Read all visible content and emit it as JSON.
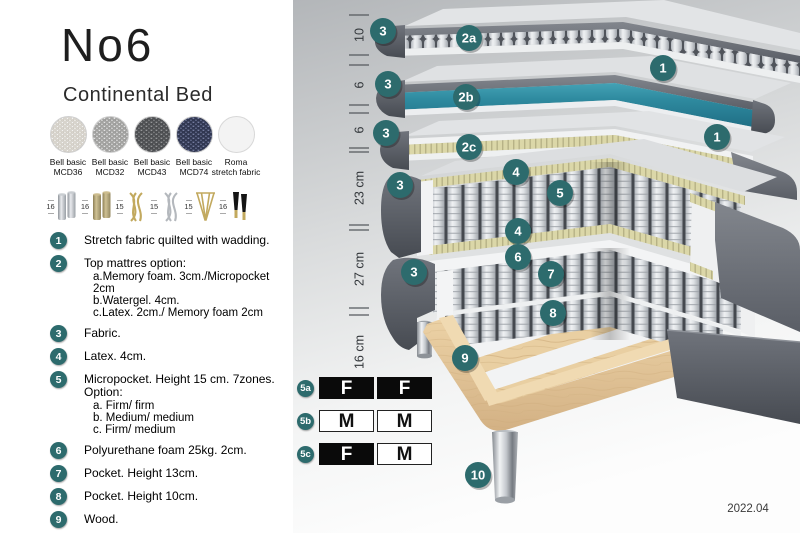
{
  "header": {
    "title": "No6",
    "subtitle": "Continental Bed"
  },
  "swatches": [
    {
      "name": "Bell basic",
      "code": "MCD36"
    },
    {
      "name": "Bell basic",
      "code": "MCD32"
    },
    {
      "name": "Bell basic",
      "code": "MCD43"
    },
    {
      "name": "Bell basic",
      "code": "MCD74"
    },
    {
      "name": "Roma",
      "code": "stretch fabric"
    }
  ],
  "legs": [
    {
      "height": "16",
      "type": "cylinder-silver"
    },
    {
      "height": "16",
      "type": "cylinder-brass"
    },
    {
      "height": "15",
      "type": "twisted-gold"
    },
    {
      "height": "15",
      "type": "twisted-silver"
    },
    {
      "height": "15",
      "type": "hairpin-gold"
    },
    {
      "height": "16",
      "type": "tapered-black-brass"
    }
  ],
  "legend": [
    {
      "num": "1",
      "text": "Stretch fabric quilted with wadding.",
      "sub": []
    },
    {
      "num": "2",
      "text": "Top mattres option:",
      "sub": [
        "a.Memory foam. 3cm./Micropocket 2cm",
        "b.Watergel. 4cm.",
        "c.Latex. 2cm./ Memory foam 2cm"
      ]
    },
    {
      "num": "3",
      "text": "Fabric.",
      "sub": []
    },
    {
      "num": "4",
      "text": "Latex. 4cm.",
      "sub": []
    },
    {
      "num": "5",
      "text": "Micropocket. Height 15 cm. 7zones. Option:",
      "sub": [
        "a. Firm/ firm",
        "b. Medium/ medium",
        "c. Firm/ medium"
      ]
    },
    {
      "num": "6",
      "text": "Polyurethane foam 25kg. 2cm.",
      "sub": []
    },
    {
      "num": "7",
      "text": "Pocket. Height 13cm.",
      "sub": []
    },
    {
      "num": "8",
      "text": "Pocket. Height 10cm.",
      "sub": []
    },
    {
      "num": "9",
      "text": "Wood.",
      "sub": []
    },
    {
      "num": "10",
      "text": "Metal leg. Height 16cm.",
      "sub": []
    }
  ],
  "diagram": {
    "measurements": [
      "10",
      "6",
      "6",
      "23 cm",
      "27 cm",
      "16 cm"
    ],
    "callouts": [
      "3",
      "2a",
      "1",
      "3",
      "2b",
      "1",
      "3",
      "2c",
      "4",
      "5",
      "3",
      "4",
      "6",
      "7",
      "3",
      "8",
      "9",
      "10"
    ],
    "firmness": [
      {
        "label": "5a",
        "cells": [
          {
            "letter": "F",
            "style": "dark"
          },
          {
            "letter": "F",
            "style": "dark"
          }
        ]
      },
      {
        "label": "5b",
        "cells": [
          {
            "letter": "M",
            "style": "light"
          },
          {
            "letter": "M",
            "style": "light"
          }
        ]
      },
      {
        "label": "5c",
        "cells": [
          {
            "letter": "F",
            "style": "dark"
          },
          {
            "letter": "M",
            "style": "light"
          }
        ]
      }
    ],
    "version": "2022.04"
  },
  "colors": {
    "accent_teal_badge": "#2d6b6d",
    "watergel_teal": "#2f8ba0",
    "latex_yellow": "#d9d5a6",
    "fabric_gray": "#6a6e76",
    "wood": "#e2c79c",
    "firm_black": "#0a0a0a"
  }
}
